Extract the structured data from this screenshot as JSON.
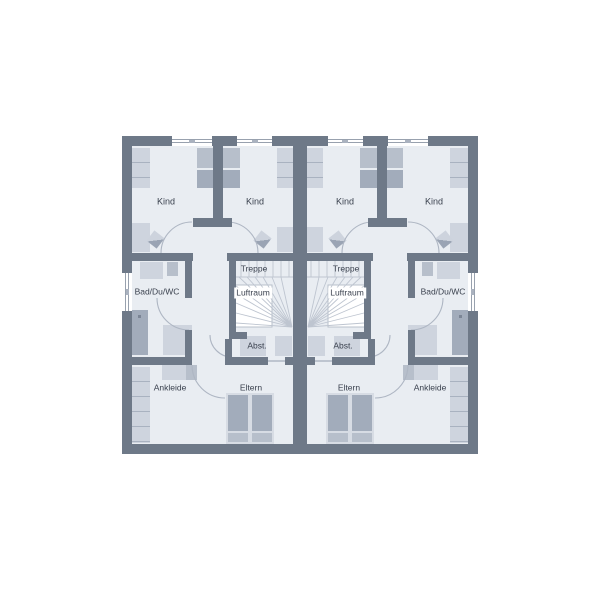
{
  "plan": {
    "type": "floor-plan",
    "rooms": {
      "kind": "Kind",
      "treppe": "Treppe",
      "luftraum": "Luftraum",
      "abstellraum": "Abst.",
      "bad": "Bad/Du/WC",
      "ankleide": "Ankleide",
      "eltern": "Eltern"
    },
    "units": [
      "left",
      "right"
    ],
    "colors": {
      "background": "#ffffff",
      "wall": "#6e7988",
      "floor": "#e9edf2",
      "furniture_light": "#ced4de",
      "furniture_mid": "#b7bfcb",
      "furniture_dark": "#a2acbb",
      "frame": "#d7dce4",
      "stair_line": "#bec5d0",
      "door_arc": "#aeb6c3",
      "void": "#ffffff",
      "text": "#3a414e"
    }
  }
}
